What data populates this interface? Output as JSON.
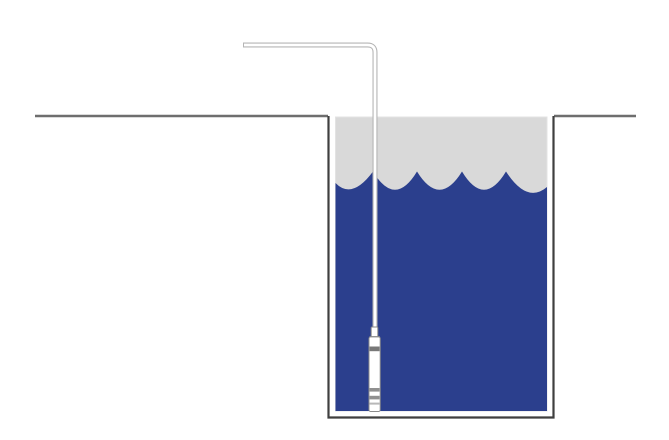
{
  "diagram": {
    "kind": "submersible-level-sensor-in-tank",
    "parts": {
      "ground_left": "ground-surface-left",
      "ground_right": "ground-surface-right",
      "tank": "tank-wall",
      "headspace": "tank-headspace",
      "liquid": "liquid-with-wave-surface",
      "cable": "sensor-cable",
      "sensor": "submersible-sensor-probe"
    },
    "colors": {
      "background": "#ffffff",
      "ground_line": "#6e6e6e",
      "tank_outline": "#3f3f3f",
      "tank_wall_fill": "#ffffff",
      "headspace_fill": "#d9d9d9",
      "headspace_edge": "#e3e3e3",
      "liquid_fill": "#2b3f8d",
      "cable_outline": "#b5b5b5",
      "cable_fill": "#ffffff",
      "sensor_outline": "#8c8c8c",
      "sensor_body_fill": "#ffffff",
      "sensor_band_dark": "#787878",
      "sensor_band_mid": "#909090",
      "sensor_band_light": "#b8b8b8"
    }
  }
}
